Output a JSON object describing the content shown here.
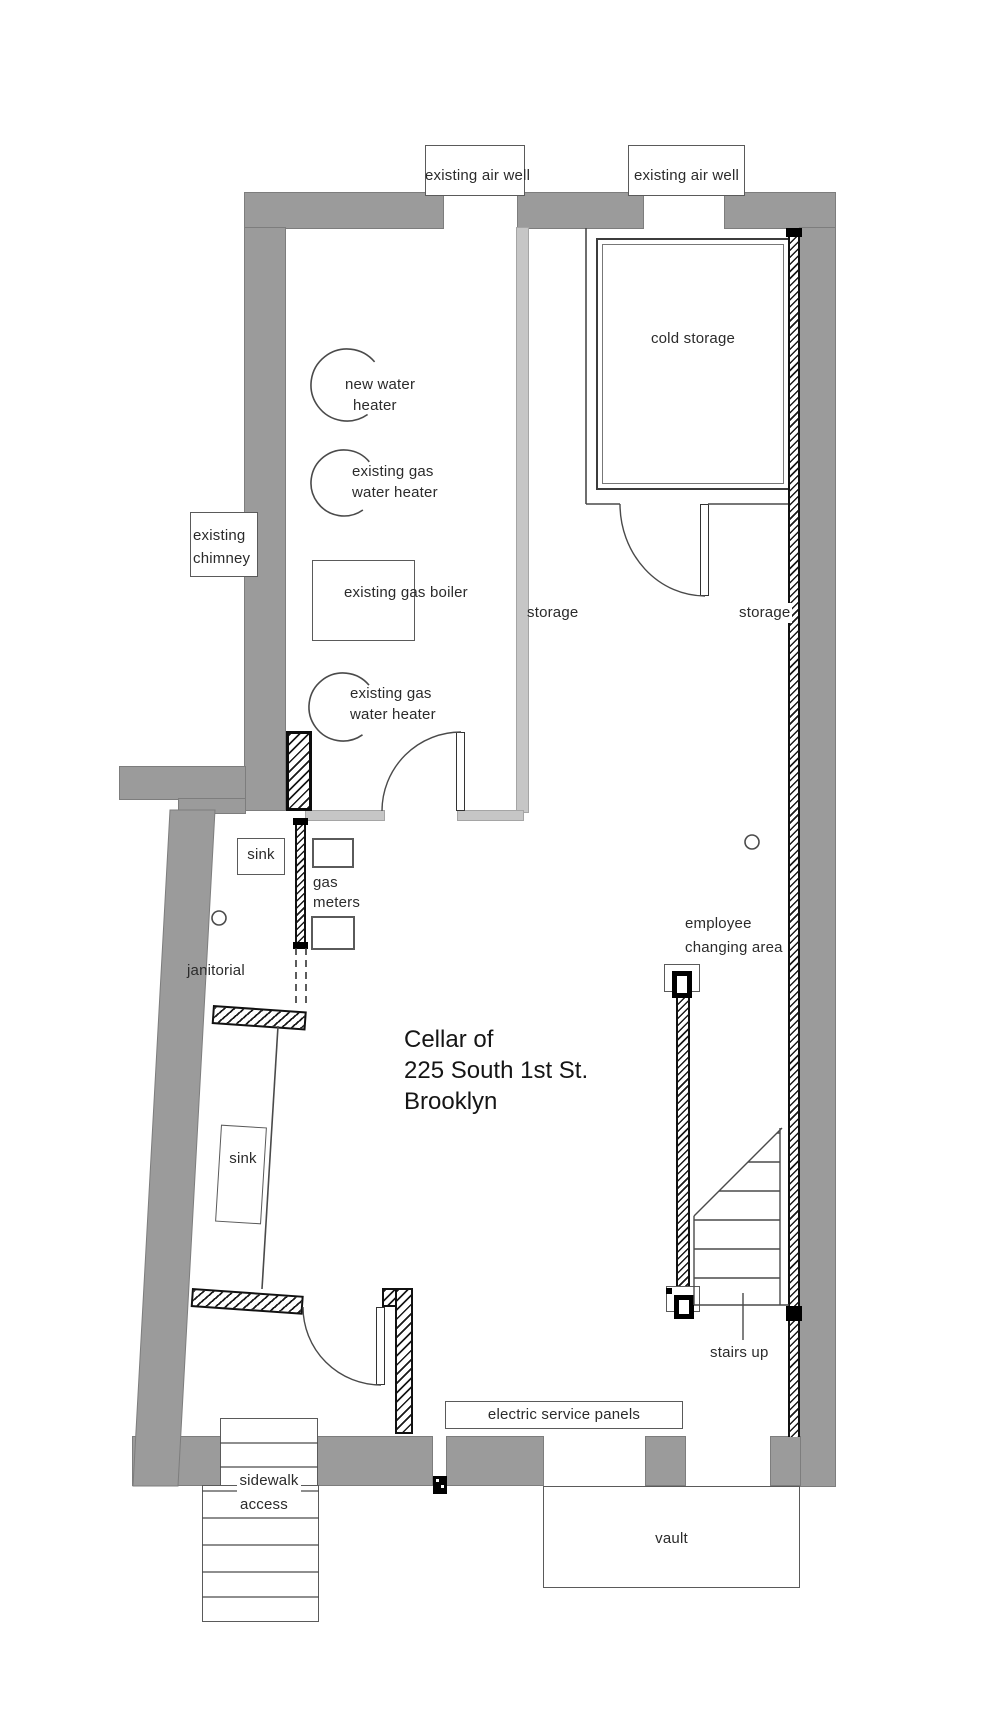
{
  "title": {
    "line1": "Cellar of",
    "line2": "225 South 1st St.",
    "line3": "Brooklyn"
  },
  "labels": {
    "air_well_left": "existing air well",
    "air_well_right": "existing air well",
    "cold_storage": "cold storage",
    "new_water_heater_line1": "new water",
    "new_water_heater_line2": "heater",
    "gas_water_heater_upper_line1": "existing  gas",
    "gas_water_heater_upper_line2": "water heater",
    "chimney_line1": "existing",
    "chimney_line2": "chimney",
    "gas_boiler": "existing gas boiler",
    "gas_water_heater_lower_line1": "existing gas",
    "gas_water_heater_lower_line2": "water heater",
    "storage_left": "storage",
    "storage_right": "storage",
    "sink_upper": "sink",
    "sink_lower": "sink",
    "gas_meters_line1": "gas",
    "gas_meters_line2": "meters",
    "janitorial": "janitorial",
    "employee_line1": "employee",
    "employee_line2": "changing area",
    "stairs_up": "stairs up",
    "electric_panels": "electric service panels",
    "sidewalk_line1": "sidewalk",
    "sidewalk_line2": "access",
    "vault": "vault"
  },
  "colors": {
    "wall_gray": "#9b9b9b",
    "partition_gray": "#c6c6c6",
    "line": "#4a4a4a",
    "text": "#2b2b2b"
  }
}
